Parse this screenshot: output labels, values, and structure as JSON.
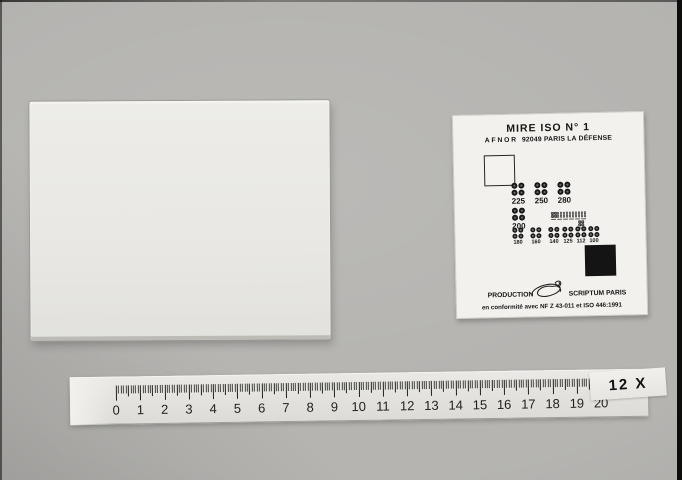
{
  "photo": {
    "magnification_label": "12 X"
  },
  "mire_chart": {
    "title": "MIRE ISO N° 1",
    "issuer": "AFNOR",
    "issuer_address": "92049 PARIS LA DÉFENSE",
    "production_label": "PRODUCTION",
    "producer_label": "SCRIPTUM PARIS",
    "conformity_line": "en conformité avec NF Z 43-011 et ISO 446:1991",
    "resolution_values_large": [
      "225",
      "250",
      "280"
    ],
    "resolution_value_medium": "200",
    "resolution_values_small": [
      "180",
      "160",
      "140",
      "125",
      "112",
      "100"
    ],
    "ink_color": "#161616",
    "card_color": "#f2f1ed"
  },
  "ruler": {
    "numbers": [
      "0",
      "1",
      "2",
      "3",
      "4",
      "5",
      "6",
      "7",
      "8",
      "9",
      "10",
      "11",
      "12",
      "13",
      "14",
      "15",
      "16",
      "17",
      "18",
      "19",
      "20"
    ]
  }
}
